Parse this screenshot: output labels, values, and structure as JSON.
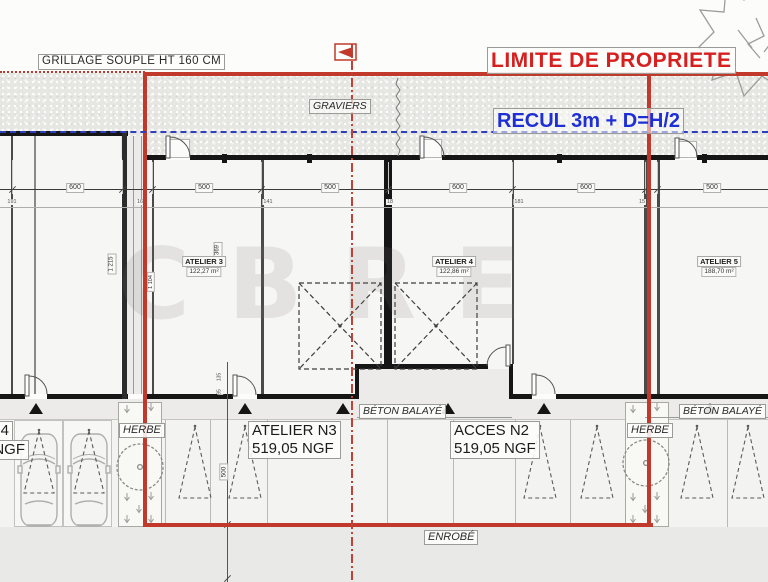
{
  "labels": {
    "fence": "GRILLAGE SOUPLE HT 160 CM",
    "property_limit": "LIMITE DE PROPRIETE",
    "setback": "RECUL 3m + D=H/2",
    "gravel": "GRAVIERS",
    "enrobe": "ENROBÉ",
    "herbe": "HERBE",
    "beton": "BÉTON BALAYÉ",
    "watermark": "CBRE"
  },
  "rooms": [
    {
      "name": "ATELIER 3",
      "area": "122,27 m²"
    },
    {
      "name": "ATELIER 4",
      "area": "122,86 m²"
    },
    {
      "name": "ATELIER 5",
      "area": "188,70 m²"
    }
  ],
  "ground": {
    "atelier_n3": {
      "title": "ATELIER N3",
      "level": "519,05 NGF"
    },
    "acces_n2": {
      "title": "ACCES N2",
      "level": "519,05 NGF"
    },
    "left_edge_fragment": {
      "line1": "N4",
      "line2": "NGF"
    }
  },
  "dims": {
    "top": [
      "600",
      "500",
      "500",
      "600",
      "600",
      "500"
    ],
    "minor": [
      "191",
      "16",
      "141",
      "18",
      "181",
      "15"
    ],
    "v1215": "1 215",
    "v1104": "1 104",
    "v369": "369",
    "v500": "500",
    "v135": "135",
    "v95": "95"
  },
  "colors": {
    "boundary_red": "#c0392b",
    "limit_text_red": "#d61f1f",
    "setback_blue": "#1f2fd6",
    "dash_blue": "#2e3fbe",
    "wall_black": "#161616"
  }
}
